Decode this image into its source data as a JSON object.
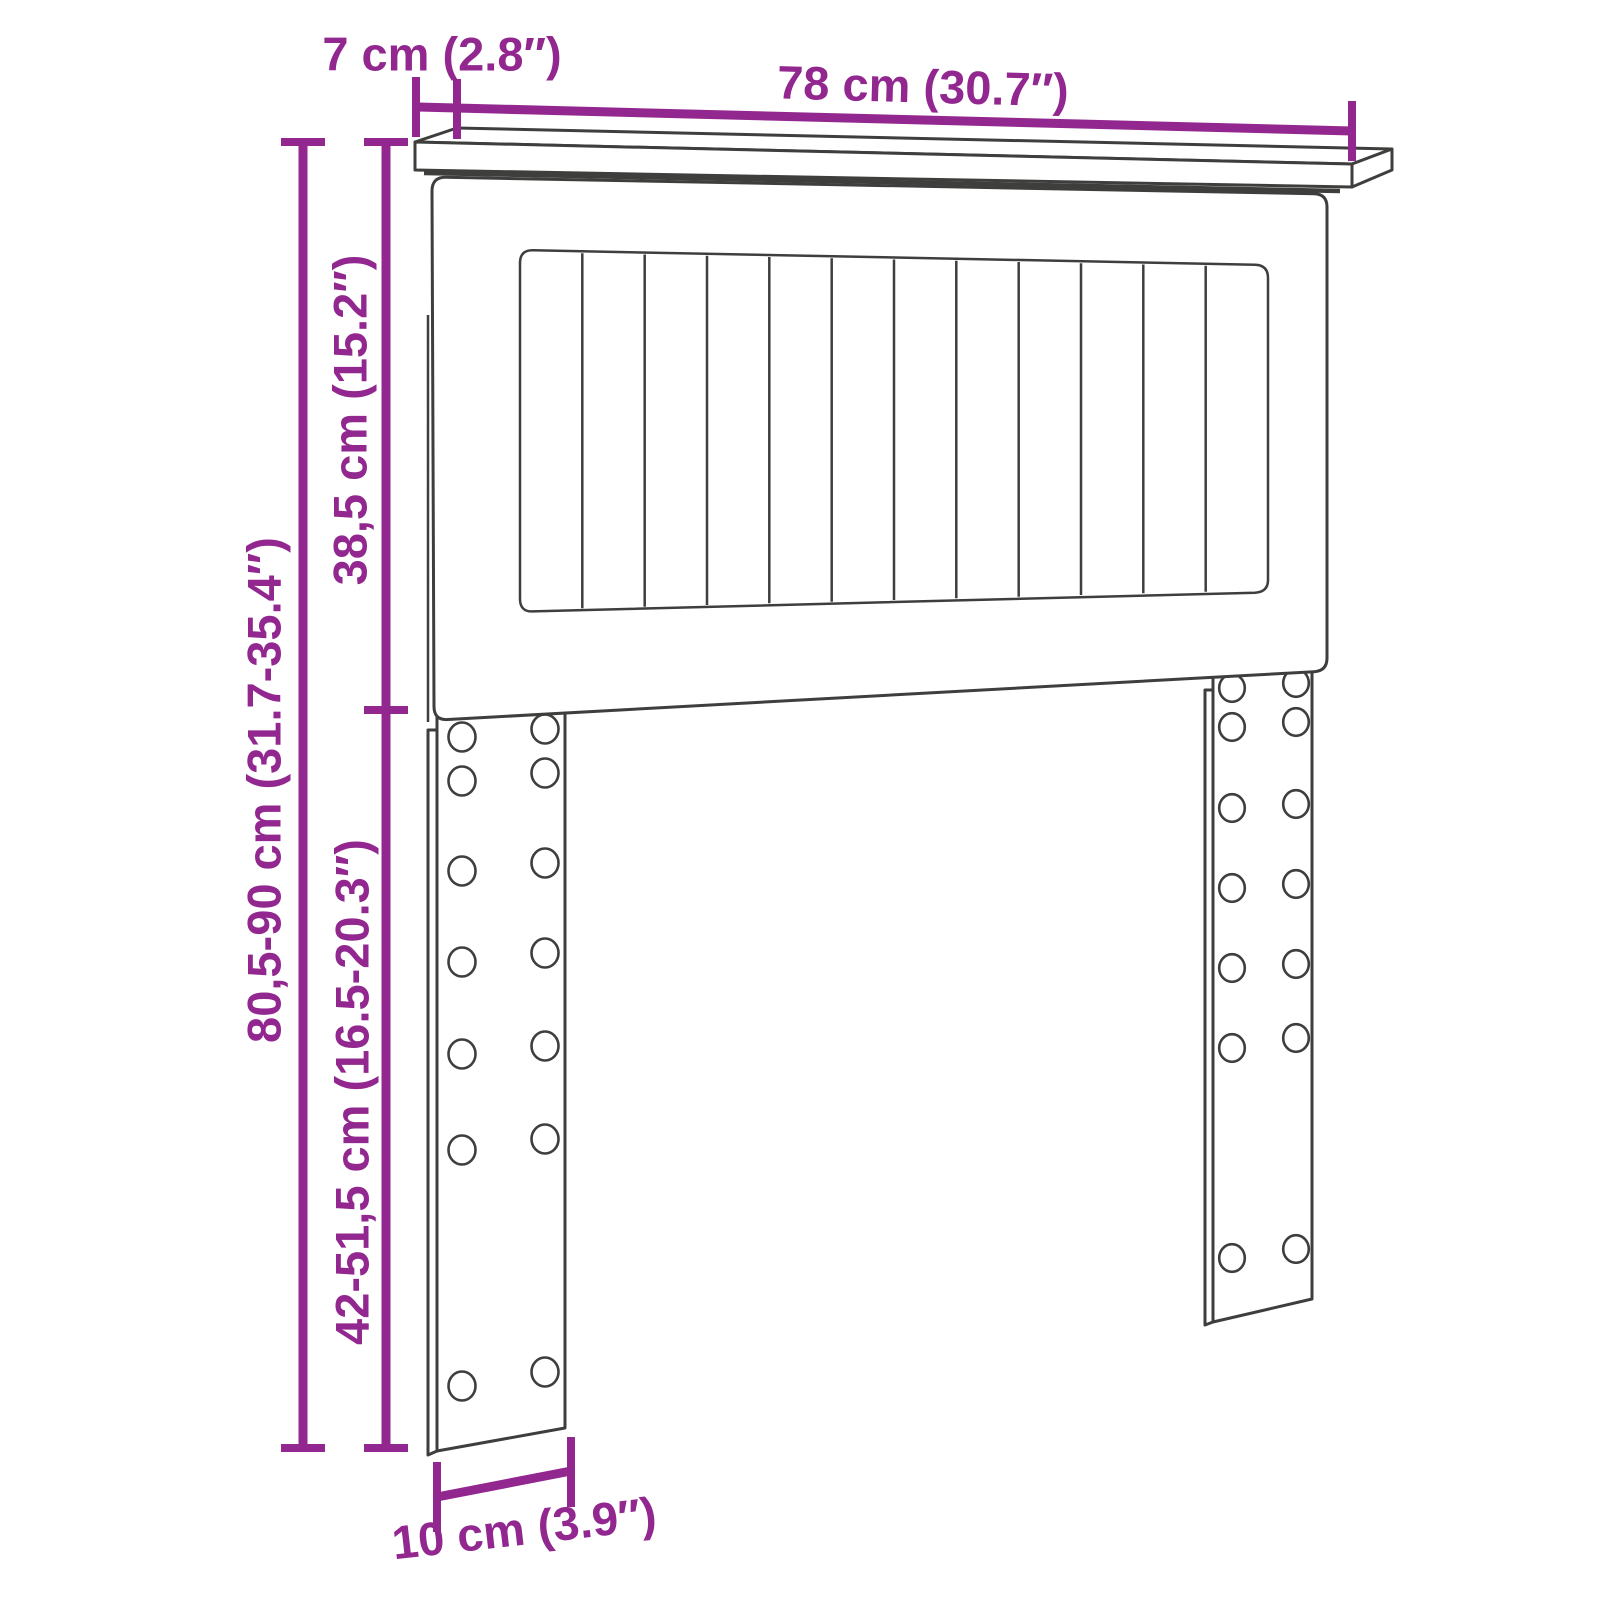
{
  "diagram": {
    "title": "headboard-dimension-diagram",
    "labels": {
      "shelf_depth": "7 cm (2.8″)",
      "width": "78 cm (30.7″)",
      "panel_height": "38,5 cm (15.2″)",
      "total_height": "80,5-90 cm (31.7-35.4″)",
      "leg_height": "42-51,5 cm (16.5-20.3″)",
      "leg_width": "10 cm (3.9″)"
    },
    "colors": {
      "dimension": "#92278F",
      "line": "#3E3E3D",
      "background": "#FFFFFF"
    },
    "structure": {
      "slat_count": 12,
      "legs": 2,
      "hole_columns_per_leg": 2,
      "hole_rows_per_leg": 7
    }
  }
}
